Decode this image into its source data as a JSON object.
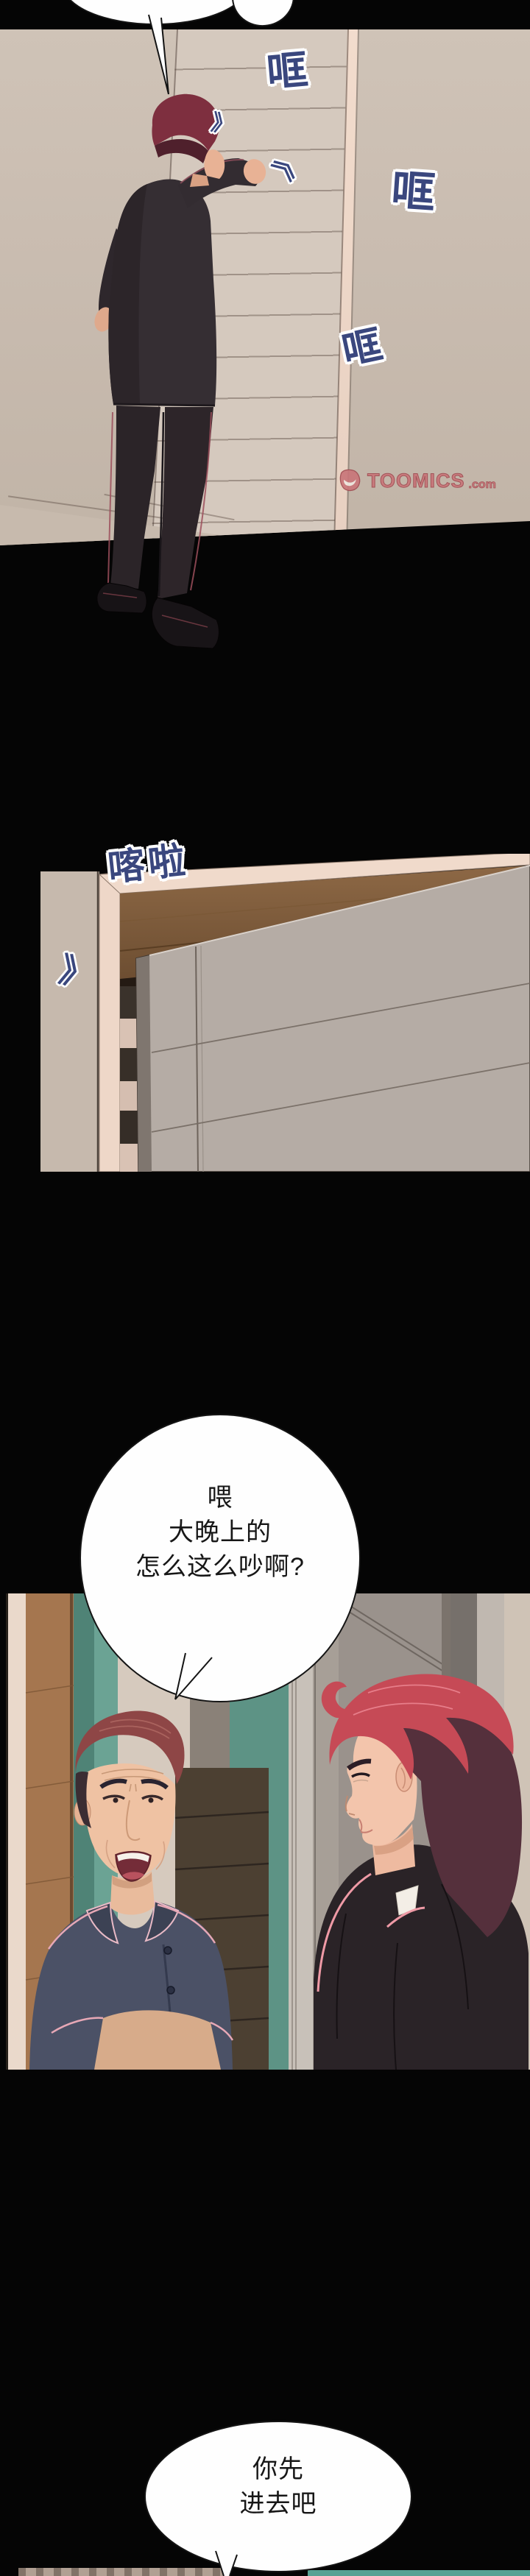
{
  "sfx": {
    "knock": "哐",
    "door_open": "喀啦",
    "impact_icon": "》"
  },
  "dialogue": {
    "middle": {
      "line1": "喂",
      "line2": "大晚上的",
      "line3": "怎么这么吵啊?"
    },
    "bottom": {
      "line1": "你先",
      "line2": "进去吧"
    }
  },
  "watermark": {
    "brand": "TOOMICS",
    "domain": ".com"
  },
  "colors": {
    "sfx_text": "#3a477e",
    "watermark_rose": "#c9767a",
    "teal_accent": "#58a294",
    "gutter_black": "#050505"
  }
}
